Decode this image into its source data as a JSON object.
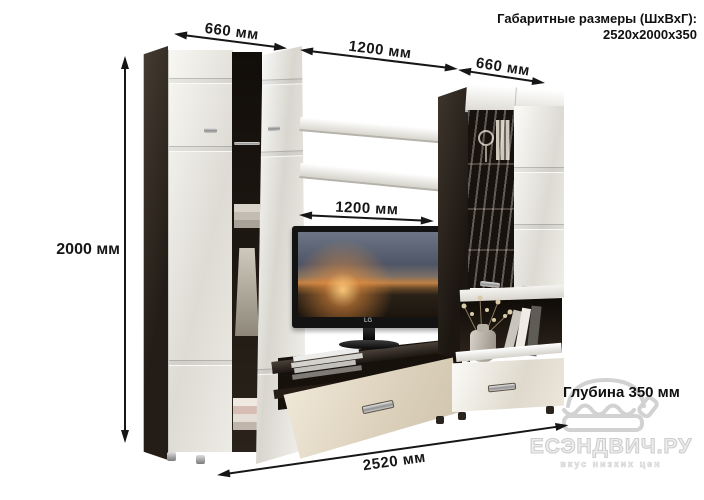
{
  "header": {
    "title_line1": "Габаритные размеры (ШхВхГ):",
    "title_line2": "2520x2000x350"
  },
  "dimensions": {
    "top_left_width": "660 мм",
    "top_middle_width": "1200 мм",
    "top_right_width": "660 мм",
    "left_height": "2000 мм",
    "inner_width": "1200 мм",
    "total_width": "2520 мм",
    "depth": "Глубина 350 мм"
  },
  "tv": {
    "brand": "LG"
  },
  "watermark": {
    "site": "ЕСЭНДВИЧ.РУ",
    "slogan": "вкус низких цен"
  },
  "colors": {
    "annotation": "#161616",
    "wenge_dark": "#241d17",
    "gloss_white": "#efeee9",
    "cream_drawer": "#e7ddcb",
    "watermark_gray": "#d4d4d4"
  }
}
